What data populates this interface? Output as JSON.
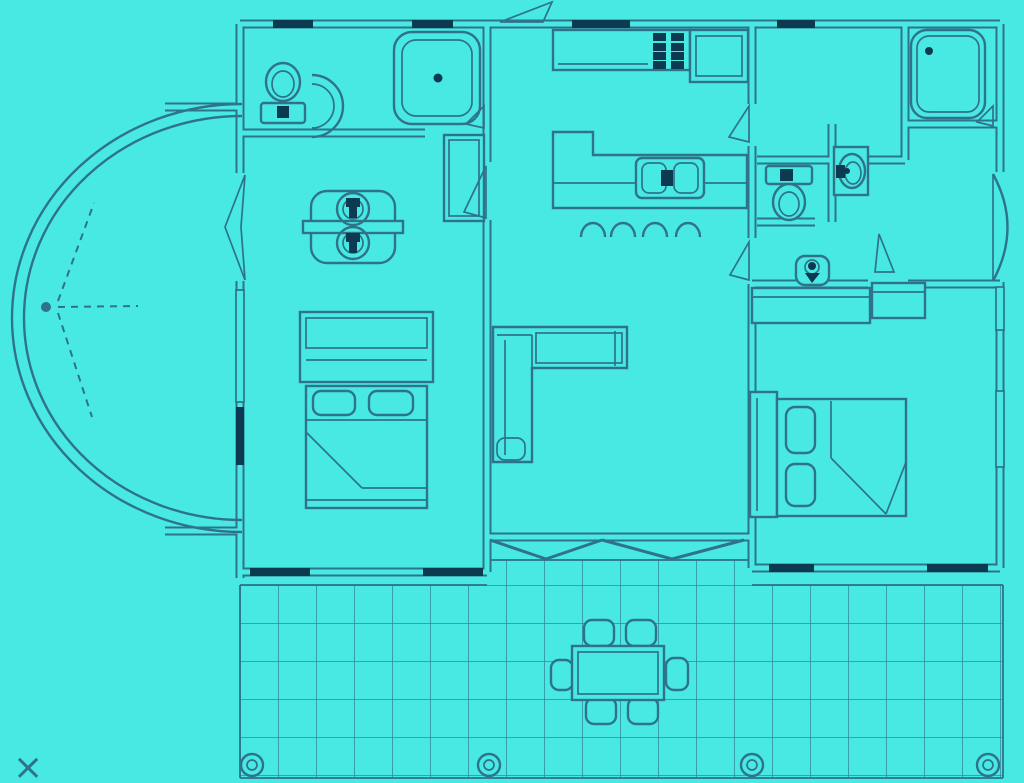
{
  "title": "house-floor-plan-blueprint",
  "colors": {
    "background": "#49E9E3",
    "line": "#2E7388",
    "dark": "#0C3B51"
  },
  "annotations": {
    "close_mark": "×"
  },
  "floor_plan": {
    "style": "cyan blueprint line drawing, no text labels",
    "rooms": [
      {
        "name": "bathroom-left",
        "fixtures": [
          "toilet",
          "curved-vanity-sink",
          "corner-shower",
          "tall-cabinet"
        ]
      },
      {
        "name": "bedroom-left",
        "fixtures": [
          "double-laundry-sink-unit",
          "dresser",
          "double-bed-with-two-pillows"
        ]
      },
      {
        "name": "kitchen",
        "fixtures": [
          "counter",
          "stove-8-burner-grid",
          "corner-counter",
          "island-with-double-sink",
          "four-bar-stools"
        ]
      },
      {
        "name": "living-room",
        "fixtures": [
          "l-shaped-sofa",
          "accordion-folding-door-to-deck"
        ]
      },
      {
        "name": "bathroom-right",
        "fixtures": [
          "bathtub",
          "toilet",
          "vanity-sink",
          "corner-hand-basin",
          "walk-in-closet"
        ]
      },
      {
        "name": "bedroom-right",
        "fixtures": [
          "desk-counter",
          "double-bed-with-two-pillows"
        ]
      },
      {
        "name": "front-bay",
        "fixtures": [
          "curved-bay-entry-arc",
          "door-swing-dashes"
        ]
      },
      {
        "name": "deck",
        "fixtures": [
          "tile-grid",
          "dining-table",
          "six-chairs",
          "four-round-posts"
        ]
      }
    ]
  }
}
